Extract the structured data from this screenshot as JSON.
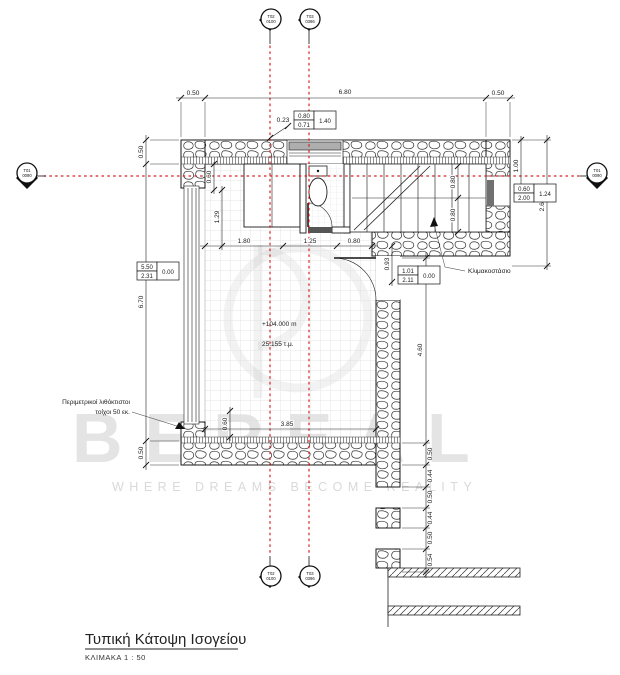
{
  "title": {
    "name": "Τυπική Κάτοψη Ισογείου",
    "scale": "ΚΛΙΜΑΚΑ  1 : 50"
  },
  "watermark": {
    "brand": "BEREAL",
    "tagline": "WHERE DREAMS BECOME REALITY"
  },
  "labels": {
    "stairwell": "Κλιμακοστάσιο",
    "perimeter_line1": "Περιμετρικοί λιθόκτιστοι",
    "perimeter_line2": "τοίχοι 50 εκ.",
    "level": "+104.000 m",
    "area": "25.155 τ.μ."
  },
  "markers": {
    "top_left": [
      "Τ02",
      "0100"
    ],
    "top_right": [
      "Τ03",
      "0396"
    ],
    "left": [
      "Τ01",
      "0090"
    ],
    "right": [
      "Τ01",
      "0090"
    ],
    "bottom_left": [
      "Τ02",
      "0100"
    ],
    "bottom_right": [
      "Τ03",
      "0396"
    ]
  },
  "dims": {
    "top_left": "0.50",
    "top_mid": "6.80",
    "top_right": "0.50",
    "offset": "0.23",
    "left_top": "0.50",
    "left_mid": "6.70",
    "left_bottom": "0.50",
    "right_top": "1.00",
    "right_mid": "2.60",
    "int_top": "0.60",
    "int_left": "1.29",
    "w_180": "1.80",
    "w_125": "1.25",
    "w_080": "0.80",
    "stair_a": "0.80",
    "stair_b": "0.80",
    "d_093": "0.93",
    "d_460": "4.60",
    "int_bottom": "0.60",
    "w_385": "3.85",
    "chain": [
      "0.50",
      "0.44",
      "0.50",
      "0.44",
      "0.50",
      "0.54"
    ]
  },
  "tags": {
    "top": {
      "a": "0.80",
      "b": "0.71",
      "c": "1.40"
    },
    "left": {
      "a": "5.50",
      "b": "2.31",
      "c": "0.00"
    },
    "right": {
      "a": "0.60",
      "b": "2.00",
      "c": "1.24"
    },
    "mid": {
      "a": "1.01",
      "b": "2.11",
      "c": "0.00"
    }
  },
  "colors": {
    "axis": "#d42020",
    "wall": "#1a1a1a",
    "tile": "#dcdcdc",
    "watermark": "#e4e4e4"
  }
}
